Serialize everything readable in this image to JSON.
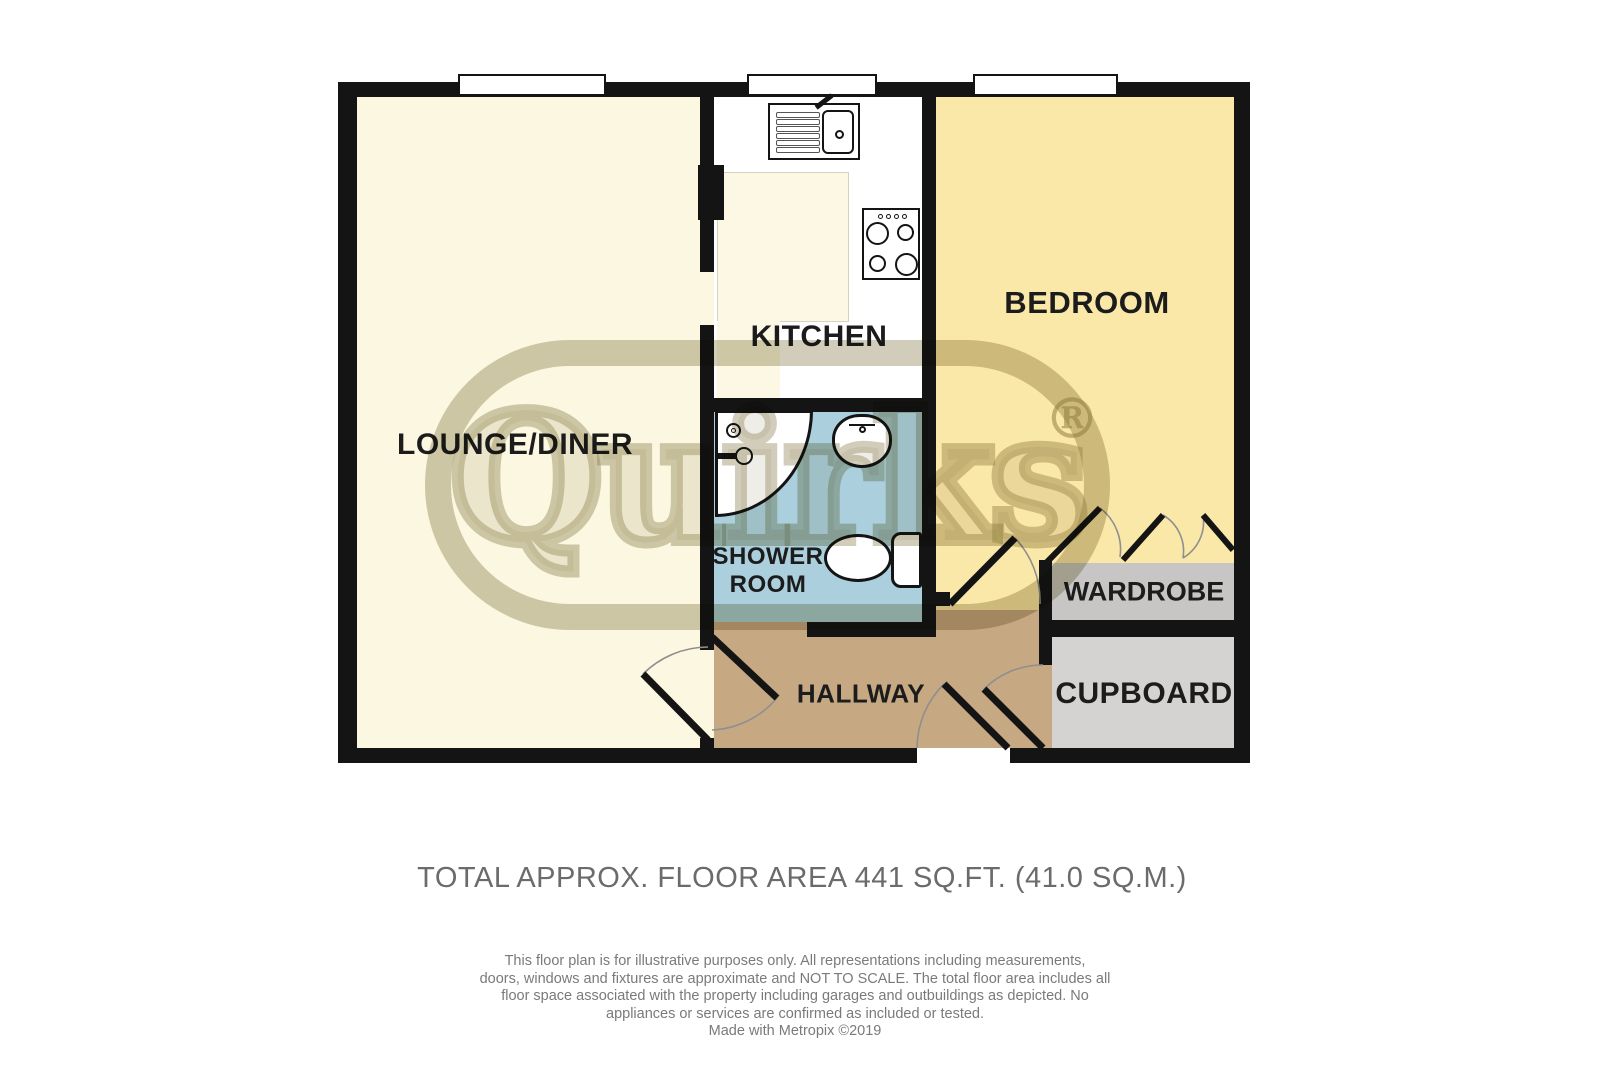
{
  "plan": {
    "rooms": {
      "lounge": {
        "label": "LOUNGE/DINER"
      },
      "kitchen": {
        "label": "KITCHEN"
      },
      "bedroom": {
        "label": "BEDROOM"
      },
      "shower": {
        "label_line1": "SHOWER",
        "label_line2": "ROOM"
      },
      "hallway": {
        "label": "HALLWAY"
      },
      "wardrobe": {
        "label": "WARDROBE"
      },
      "cupboard": {
        "label": "CUPBOARD"
      }
    },
    "fixtures": [
      "kitchen-sink",
      "hob",
      "shower-enclosure",
      "washbasin",
      "toilet"
    ],
    "window_count": 3
  },
  "watermark": {
    "brand": "Quirks",
    "registered_mark": "®"
  },
  "footer": {
    "total_area": "TOTAL APPROX. FLOOR AREA 441 SQ.FT. (41.0 SQ.M.)",
    "disclaimer_lines": [
      "This floor plan is for illustrative purposes only. All representations including measurements,",
      "doors, windows and fixtures are approximate and NOT TO SCALE. The total floor area includes all",
      "floor space associated with the property including garages and outbuildings as depicted. No",
      "appliances or services are confirmed as included or tested."
    ],
    "credit": "Made with Metropix ©2019"
  },
  "colors": {
    "wall": "#141414",
    "lounge-floor": "#FBF7E1",
    "kitchen-floor": "#FFFFFF",
    "kitchen-inset": "#FCF8E4",
    "bedroom-floor": "#FAE8A9",
    "shower-floor": "#ABCFDC",
    "hallway-floor": "#C6A883",
    "wardrobe-floor": "#C7C6C4",
    "cupboard-floor": "#D4D3D1",
    "watermark": "#8C8252",
    "label-text": "#1C1C1C",
    "footer-text": "#6B6B6B"
  }
}
